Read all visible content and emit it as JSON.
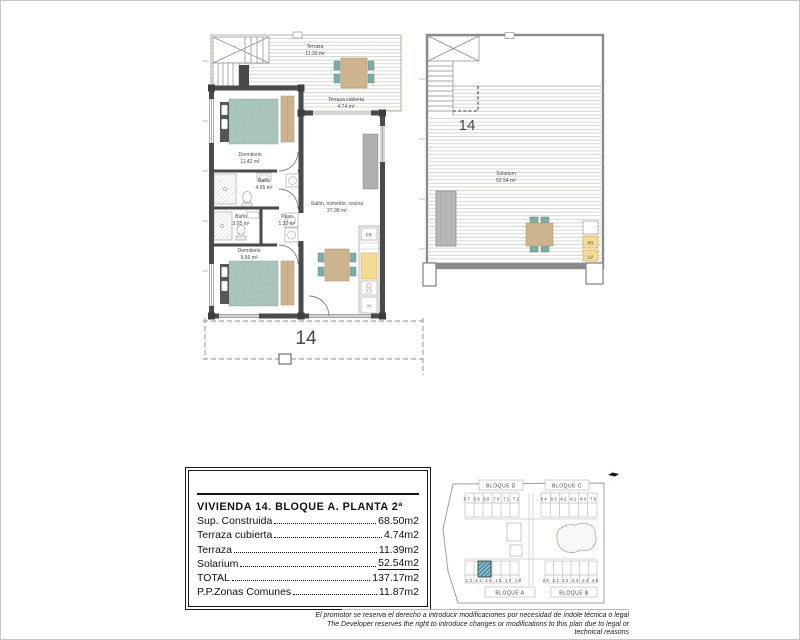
{
  "main_plan": {
    "unit_label": "14",
    "rooms": {
      "terraza": {
        "name": "Terraza",
        "area": "11.39 m²"
      },
      "terraza_cubierta": {
        "name": "Terraza cubierta",
        "area": "4.74 m²"
      },
      "dormitorio1": {
        "name": "Dormitorio",
        "area": "11.42 m²"
      },
      "bano1": {
        "name": "Baño",
        "area": "4.65 m²"
      },
      "bano2": {
        "name": "Baño",
        "area": "3.05 m²"
      },
      "paso": {
        "name": "Paso",
        "area": "1.32 m²"
      },
      "dormitorio2": {
        "name": "Dormitorio",
        "area": "9.56 m²"
      },
      "salon": {
        "name": "Salón, comedor, cocina",
        "area": "27.98 m²"
      }
    },
    "appliances": {
      "fridge": "FR",
      "oven": "H"
    }
  },
  "solarium_plan": {
    "unit_label": "14",
    "room": {
      "name": "Solarium",
      "area": "52.54 m²"
    },
    "appliances": {
      "fridge": "FR",
      "dishwasher": "LV"
    }
  },
  "info_table": {
    "title": "VIVIENDA 14. BLOQUE A. PLANTA 2ª",
    "rows": [
      {
        "label": "Sup. Construida",
        "value": "68.50m2"
      },
      {
        "label": "Terraza cubierta",
        "value": "4.74m2"
      },
      {
        "label": "Terraza",
        "value": "11.39m2"
      },
      {
        "label": "Solarium",
        "value": "52.54m2"
      },
      {
        "label": "TOTAL",
        "value": "137.17m2"
      },
      {
        "label": "P.P.Zonas Comunes",
        "value": "11.87m2"
      }
    ]
  },
  "site_plan": {
    "blocks": {
      "d": "BLOQUE D",
      "c": "BLOQUE C",
      "a": "BLOQUE A",
      "b": "BLOQUE B"
    },
    "unit_numbers": {
      "top_left": "67 68 69 70 71 72",
      "top_right": "84 83 82 81 80 79",
      "bottom_left": "13 14 15 16 17 18",
      "bottom_right": "20 21 22 23 24 25"
    },
    "highlighted_unit": "14"
  },
  "disclaimer": {
    "es": "El promotor se reserva el derecho a introducir modificaciones por necesidad de índole técnica o legal",
    "en": "The Developer reserves the right to introduce changes or modifications to this plan due to legal or technical reasons"
  },
  "colors": {
    "wall": "#4a4a4a",
    "deck_line": "#cbd1c9",
    "teal_furniture": "#7fada4",
    "bed_teal": "#aac6bd",
    "wood_tan": "#cdb48f",
    "appliance_yellow": "#f4da92",
    "sofa_gray": "#b0b0b0",
    "site_highlight": "#82bccb"
  }
}
